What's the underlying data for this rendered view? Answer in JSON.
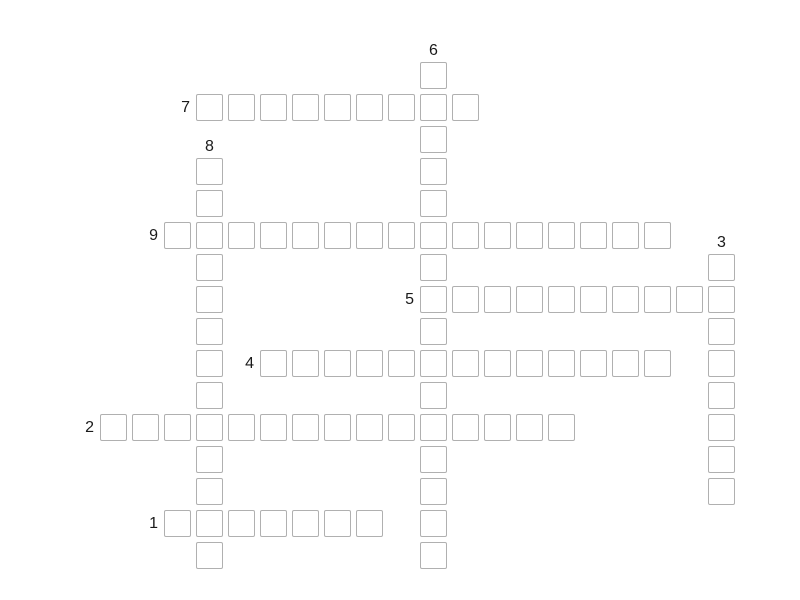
{
  "puzzle": {
    "type": "crossword",
    "state": "empty",
    "colors": {
      "background": "#ffffff",
      "cell_fill": "#ffffff",
      "cell_border": "#b0b0b0",
      "number_color": "#1a1a1a"
    },
    "layout": {
      "origin_x": 100,
      "origin_y": 62,
      "pitch": 32,
      "cell_size": 27
    },
    "words": [
      {
        "number": "1",
        "direction": "across",
        "row": 14,
        "col": 2,
        "length": 7
      },
      {
        "number": "2",
        "direction": "across",
        "row": 11,
        "col": 0,
        "length": 15
      },
      {
        "number": "3",
        "direction": "down",
        "row": 6,
        "col": 19,
        "length": 8
      },
      {
        "number": "4",
        "direction": "across",
        "row": 9,
        "col": 5,
        "length": 13
      },
      {
        "number": "5",
        "direction": "across",
        "row": 7,
        "col": 10,
        "length": 10
      },
      {
        "number": "6",
        "direction": "down",
        "row": 0,
        "col": 10,
        "length": 16
      },
      {
        "number": "7",
        "direction": "across",
        "row": 1,
        "col": 3,
        "length": 9
      },
      {
        "number": "8",
        "direction": "down",
        "row": 3,
        "col": 3,
        "length": 13
      },
      {
        "number": "9",
        "direction": "across",
        "row": 5,
        "col": 2,
        "length": 16
      }
    ]
  }
}
